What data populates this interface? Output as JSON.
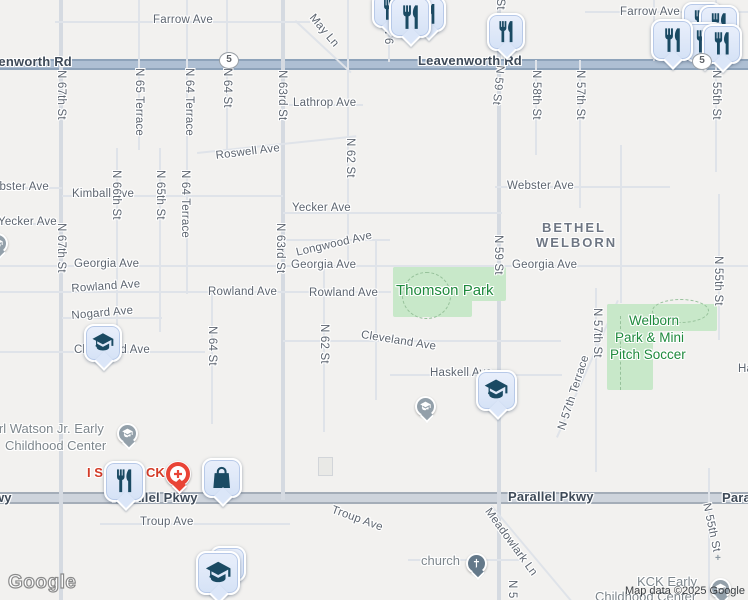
{
  "map": {
    "logo": "Google",
    "attribution": "Map data ©2025 Google",
    "route_shield_number": "5",
    "colors": {
      "background": "#f2f1ef",
      "park_fill": "#c8e8c9",
      "park_label": "#1f8a3d",
      "major_road_band": "#aebfd3",
      "secondary_road_band": "#ced4dc",
      "marker_fill": "#dbe6f8",
      "marker_glyph": "#1a4a63",
      "hospital_red": "#e94436",
      "poi_label_red": "#d33b27"
    },
    "labels": [
      {
        "text": "Leavenworth Rd",
        "kind": "road",
        "x": -32,
        "y": 54
      },
      {
        "text": "Leavenworth Rd",
        "kind": "road",
        "x": 418,
        "y": 53
      },
      {
        "text": "Parallel Pkwy",
        "kind": "road",
        "x": -74,
        "y": 490
      },
      {
        "text": "Parallel Pkwy",
        "kind": "road",
        "x": 112,
        "y": 490
      },
      {
        "text": "Parallel Pkwy",
        "kind": "road",
        "x": 508,
        "y": 489
      },
      {
        "text": "Parallel Pkwy",
        "kind": "road",
        "x": 722,
        "y": 490
      },
      {
        "text": "Farrow Ave",
        "kind": "street",
        "x": 153,
        "y": 14
      },
      {
        "text": "Farrow Ave",
        "kind": "street",
        "x": 620,
        "y": 6
      },
      {
        "text": "May Ln",
        "kind": "street",
        "x": 316,
        "y": 12,
        "rot": 50
      },
      {
        "text": "Lathrop Ave",
        "kind": "street",
        "x": 293,
        "y": 97
      },
      {
        "text": "Roswell Ave",
        "kind": "street",
        "x": 215,
        "y": 150,
        "rot": -7
      },
      {
        "text": "Webster Ave",
        "kind": "street",
        "x": -18,
        "y": 181
      },
      {
        "text": "Webster Ave",
        "kind": "street",
        "x": 507,
        "y": 180
      },
      {
        "text": "Kimball Ave",
        "kind": "street",
        "x": 72,
        "y": 188
      },
      {
        "text": "Yecker Ave",
        "kind": "street",
        "x": -2,
        "y": 216
      },
      {
        "text": "Yecker Ave",
        "kind": "street",
        "x": 292,
        "y": 202
      },
      {
        "text": "Longwood Ave",
        "kind": "street",
        "x": 295,
        "y": 247,
        "rot": -13
      },
      {
        "text": "Georgia Ave",
        "kind": "street",
        "x": 74,
        "y": 258
      },
      {
        "text": "Georgia Ave",
        "kind": "street",
        "x": 291,
        "y": 259
      },
      {
        "text": "Georgia Ave",
        "kind": "street",
        "x": 512,
        "y": 259
      },
      {
        "text": "Rowland Ave",
        "kind": "street",
        "x": 71,
        "y": 283,
        "rot": -4
      },
      {
        "text": "Rowland Ave",
        "kind": "street",
        "x": 208,
        "y": 286
      },
      {
        "text": "Rowland Ave",
        "kind": "street",
        "x": 309,
        "y": 287
      },
      {
        "text": "Nogard Ave",
        "kind": "street",
        "x": 71,
        "y": 310,
        "rot": -5
      },
      {
        "text": "Cleveland Ave",
        "kind": "street",
        "x": 74,
        "y": 344
      },
      {
        "text": "Cleveland Ave",
        "kind": "street",
        "x": 362,
        "y": 329,
        "rot": 9
      },
      {
        "text": "Haskell Ave",
        "kind": "street",
        "x": 430,
        "y": 367
      },
      {
        "text": "Haskell Ave",
        "kind": "street",
        "x": 738,
        "y": 363
      },
      {
        "text": "Troup Ave",
        "kind": "street",
        "x": 140,
        "y": 516
      },
      {
        "text": "Troup Ave",
        "kind": "street",
        "x": 334,
        "y": 504,
        "rot": 20
      },
      {
        "text": "Meadowlark Ln",
        "kind": "street",
        "x": 492,
        "y": 506,
        "rot": 54
      },
      {
        "text": "N 67th St",
        "kind": "street",
        "x": 67,
        "y": 70,
        "rot": 90
      },
      {
        "text": "N 67th St",
        "kind": "street",
        "x": 67,
        "y": 223,
        "rot": 90
      },
      {
        "text": "N 65 Terrace",
        "kind": "street",
        "x": 145,
        "y": 68,
        "rot": 90
      },
      {
        "text": "N 64 Terrace",
        "kind": "street",
        "x": 195,
        "y": 68,
        "rot": 90
      },
      {
        "text": "N 64 St",
        "kind": "street",
        "x": 233,
        "y": 68,
        "rot": 90
      },
      {
        "text": "N 63rd St",
        "kind": "street",
        "x": 288,
        "y": 70,
        "rot": 90
      },
      {
        "text": "N 66th St",
        "kind": "street",
        "x": 122,
        "y": 170,
        "rot": 90
      },
      {
        "text": "N 65th St",
        "kind": "street",
        "x": 166,
        "y": 170,
        "rot": 90
      },
      {
        "text": "N 64 Terrace",
        "kind": "street",
        "x": 191,
        "y": 170,
        "rot": 90
      },
      {
        "text": "N 63rd St",
        "kind": "street",
        "x": 286,
        "y": 223,
        "rot": 90
      },
      {
        "text": "N 62 St",
        "kind": "street",
        "x": 356,
        "y": 138,
        "rot": 90
      },
      {
        "text": "N 62 St",
        "kind": "street",
        "x": 330,
        "y": 324,
        "rot": 90
      },
      {
        "text": "N 64 St",
        "kind": "street",
        "x": 218,
        "y": 326,
        "rot": 90
      },
      {
        "text": "N 59 St",
        "kind": "street",
        "x": 506,
        "y": -30,
        "rot": 90
      },
      {
        "text": "N 59 St",
        "kind": "street",
        "x": 506,
        "y": 66,
        "rot": 96
      },
      {
        "text": "N 59 St",
        "kind": "street",
        "x": 504,
        "y": 235,
        "rot": 90
      },
      {
        "text": "N 58th St",
        "kind": "street",
        "x": 542,
        "y": 70,
        "rot": 90
      },
      {
        "text": "N 57th St",
        "kind": "street",
        "x": 586,
        "y": 70,
        "rot": 90
      },
      {
        "text": "N 57th St",
        "kind": "street",
        "x": 603,
        "y": 308,
        "rot": 90
      },
      {
        "text": "N 57th Terrace",
        "kind": "street",
        "x": 556,
        "y": 428,
        "rot": -72
      },
      {
        "text": "N 55th St",
        "kind": "street",
        "x": 722,
        "y": 70,
        "rot": 90
      },
      {
        "text": "N 55th St",
        "kind": "street",
        "x": 724,
        "y": 256,
        "rot": 90
      },
      {
        "text": "N 55th St",
        "kind": "street",
        "x": 712,
        "y": 502,
        "rot": 78
      },
      {
        "text": "N 5",
        "kind": "street",
        "x": 518,
        "y": 580,
        "rot": 90
      },
      {
        "text": "N 6",
        "kind": "street",
        "x": 394,
        "y": 26,
        "rot": 90
      },
      {
        "text": "BETHEL",
        "kind": "area",
        "x": 542,
        "y": 220
      },
      {
        "text": "WELBORN",
        "kind": "area",
        "x": 536,
        "y": 235
      },
      {
        "text": "Thomson Park",
        "kind": "park-lg",
        "x": 396,
        "y": 282
      },
      {
        "text": "Welborn",
        "kind": "park",
        "x": 629,
        "y": 313
      },
      {
        "text": "Park & Mini",
        "kind": "park",
        "x": 615,
        "y": 330
      },
      {
        "text": "Pitch Soccer",
        "kind": "park",
        "x": 610,
        "y": 347
      },
      {
        "text": "Earl Watson Jr. Early",
        "kind": "poi",
        "x": -17,
        "y": 421
      },
      {
        "text": "Childhood Center",
        "kind": "poi",
        "x": 5,
        "y": 438
      },
      {
        "text": "church",
        "kind": "poi",
        "x": 421,
        "y": 553
      },
      {
        "text": "KCK Early",
        "kind": "poi",
        "x": 637,
        "y": 574
      },
      {
        "text": "Childhood Center",
        "kind": "poi",
        "x": 595,
        "y": 589
      },
      {
        "text": "I S",
        "kind": "poi-red",
        "x": 87,
        "y": 465
      },
      {
        "text": "CK",
        "kind": "poi-red",
        "x": 146,
        "y": 465
      }
    ],
    "markers": [
      {
        "icon": "restaurant",
        "x": 372,
        "y": -8,
        "size": 36
      },
      {
        "icon": "restaurant",
        "x": 410,
        "y": -4,
        "size": 36
      },
      {
        "icon": "restaurant",
        "x": 389,
        "y": -4,
        "size": 42
      },
      {
        "icon": "restaurant",
        "x": 487,
        "y": 13,
        "size": 38
      },
      {
        "icon": "restaurant",
        "x": 682,
        "y": 2,
        "size": 40
      },
      {
        "icon": "restaurant",
        "x": 699,
        "y": 5,
        "size": 40
      },
      {
        "icon": "restaurant",
        "x": 684,
        "y": 22,
        "size": 40
      },
      {
        "icon": "restaurant",
        "x": 651,
        "y": 19,
        "size": 42
      },
      {
        "icon": "restaurant",
        "x": 702,
        "y": 24,
        "size": 40
      },
      {
        "icon": "restaurant",
        "x": 104,
        "y": 461,
        "size": 41
      },
      {
        "icon": "school",
        "x": 84,
        "y": 324,
        "size": 38
      },
      {
        "icon": "school",
        "x": 476,
        "y": 370,
        "size": 41
      },
      {
        "icon": "school",
        "x": 210,
        "y": 546,
        "size": 36
      },
      {
        "icon": "school",
        "x": 196,
        "y": 551,
        "size": 44
      },
      {
        "icon": "shopping-bag",
        "x": 202,
        "y": 458,
        "size": 40
      },
      {
        "icon": "hospital",
        "x": 165,
        "y": 461
      }
    ],
    "poi_circles": [
      {
        "icon": "school",
        "x": 117,
        "y": 423
      },
      {
        "icon": "school",
        "x": 415,
        "y": 396
      },
      {
        "icon": "church",
        "x": 466,
        "y": 553,
        "dark": true
      },
      {
        "icon": "school",
        "x": 710,
        "y": 578
      },
      {
        "icon": "school",
        "x": -13,
        "y": 233
      }
    ],
    "shields": [
      {
        "x": 219,
        "y": 52
      },
      {
        "x": 692,
        "y": 53
      }
    ]
  }
}
